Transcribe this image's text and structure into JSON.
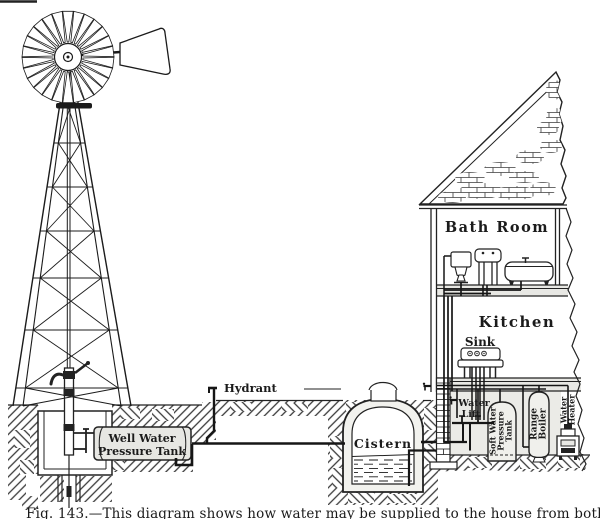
{
  "figure": {
    "caption": "Fig. 143.—This diagram shows how water may be supplied to the house from both well and cistern.",
    "labels": {
      "hydrant": "Hydrant",
      "well_tank_1": "Well Water",
      "well_tank_2": "Pressure Tank",
      "cistern": "Cistern",
      "bath_room": "Bath Room",
      "kitchen": "Kitchen",
      "sink": "Sink",
      "water_lift_1": "Water",
      "water_lift_2": "Lift",
      "soft_tank_1": "Soft Water",
      "soft_tank_2": "Pressure",
      "soft_tank_3": "Tank",
      "range_boiler_1": "Range",
      "range_boiler_2": "Boiler",
      "water_heater_1": "Water",
      "water_heater_2": "Heater"
    },
    "colors": {
      "ink": "#1b1b1b",
      "paper": "#ffffff",
      "tank_face": "#e7e7e3",
      "floor_shade": "#e8e8e4",
      "basement_shade": "#ebebe7"
    }
  }
}
